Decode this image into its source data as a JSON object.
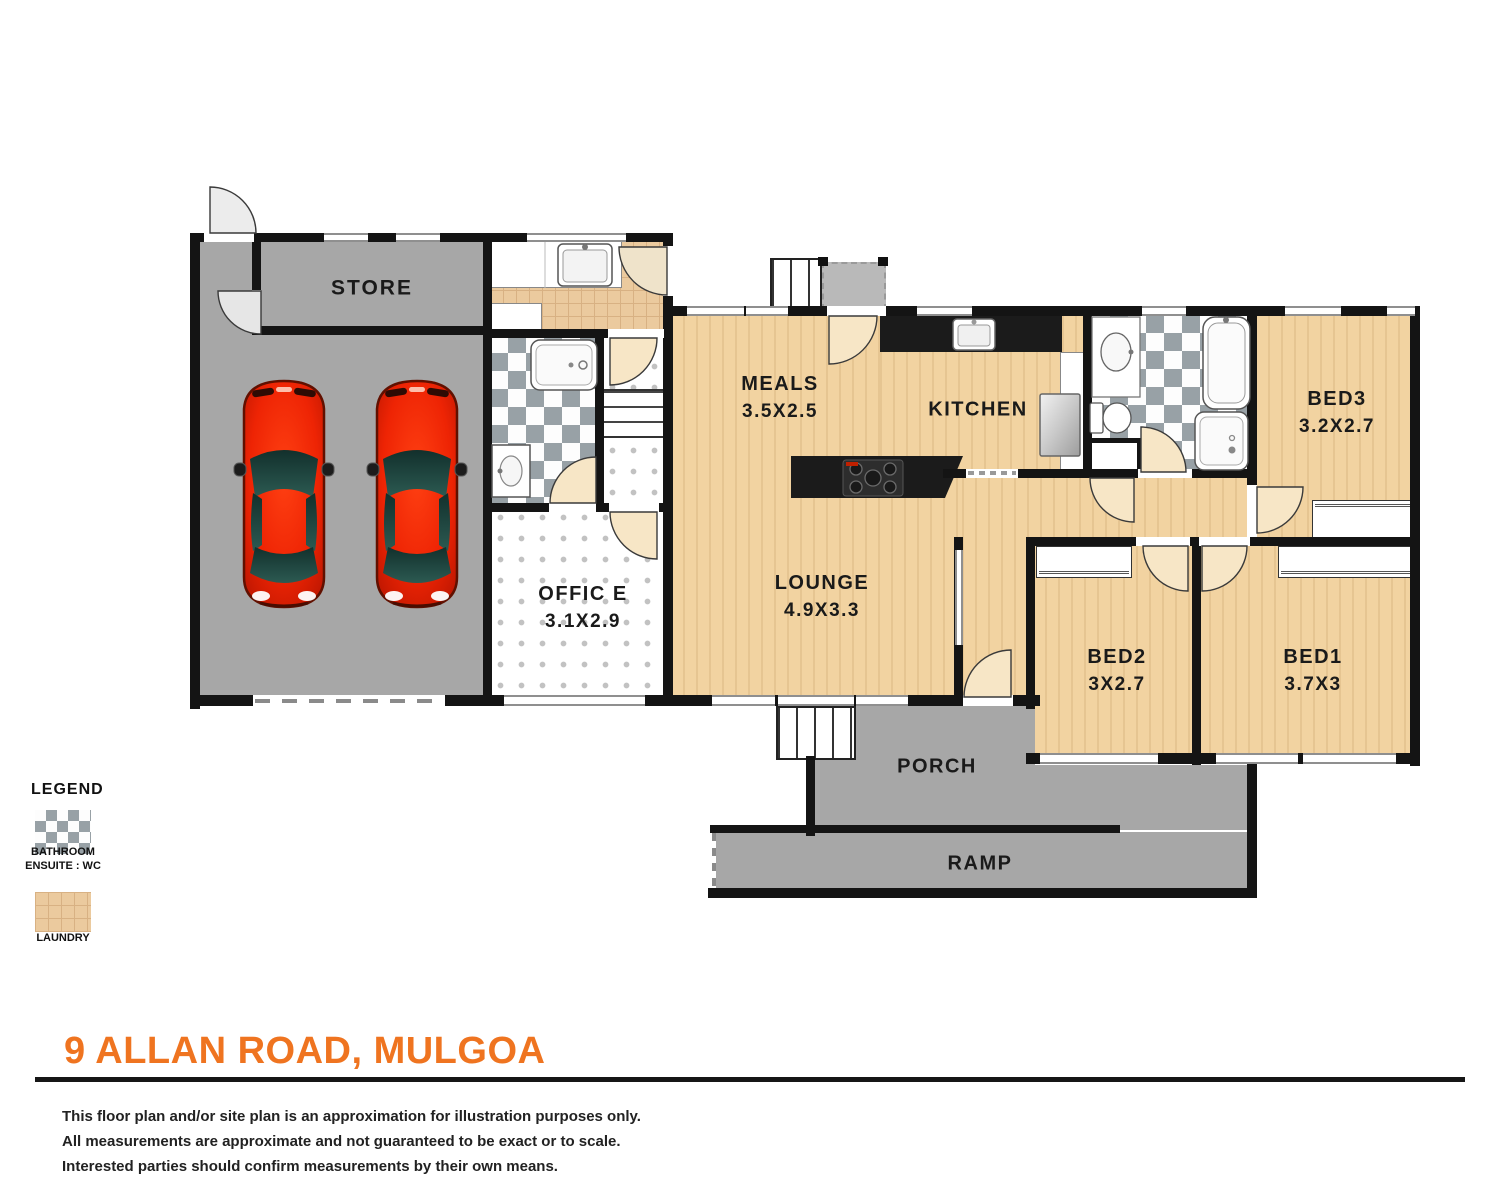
{
  "rooms": {
    "store": {
      "name": "STORE"
    },
    "meals": {
      "name": "MEALS",
      "dims": "3.5X2.5"
    },
    "kitchen": {
      "name": "KITCHEN"
    },
    "bed3": {
      "name": "BED3",
      "dims": "3.2X2.7"
    },
    "office": {
      "name": "OFFIC E",
      "dims": "3.1X2.9"
    },
    "lounge": {
      "name": "LOUNGE",
      "dims": "4.9X3.3"
    },
    "bed2": {
      "name": "BED2",
      "dims": "3X2.7"
    },
    "bed1": {
      "name": "BED1",
      "dims": "3.7X3"
    },
    "porch": {
      "name": "PORCH"
    },
    "ramp": {
      "name": "RAMP"
    }
  },
  "legend": {
    "title": "LEGEND",
    "bathroom_line1": "BATHROOM",
    "bathroom_line2": "ENSUITE : WC",
    "laundry_label": "LAUNDRY"
  },
  "footer": {
    "title": "9 ALLAN ROAD, MULGOA",
    "disclaimer_1": "This floor plan and/or site plan is an approximation for illustration purposes only.",
    "disclaimer_2": "All measurements are approximate and not guaranteed to be exact or to scale.",
    "disclaimer_3": "Interested parties should confirm measurements by their own means."
  },
  "palette": {
    "accent_orange": "#EF7420",
    "wall_black": "#141414",
    "wood_floor": "#F2D3A1",
    "concrete_gray": "#A7A7A7",
    "bath_tile_gray": "#98A1A6",
    "laundry_tile_tan": "#EBCA9E",
    "car_red": "#E82405"
  }
}
